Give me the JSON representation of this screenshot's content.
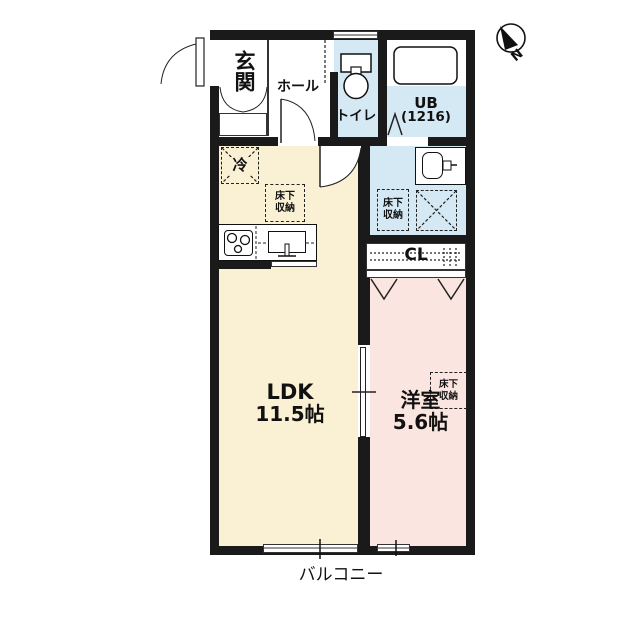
{
  "rooms": {
    "entrance": {
      "label": "玄関"
    },
    "hall": {
      "label": "ホール"
    },
    "toilet": {
      "label": "トイレ"
    },
    "unit_bath": {
      "label": "UB",
      "size": "(1216)"
    },
    "ldk": {
      "label": "LDK",
      "size": "11.5帖"
    },
    "western_room": {
      "label": "洋室",
      "size": "5.6帖"
    },
    "closet": {
      "label": "CL"
    },
    "balcony": {
      "label": "バルコニー"
    }
  },
  "fixtures": {
    "refrigerator": "冷",
    "underfloor_storage": "床下収納",
    "underfloor_storage_line1": "床下",
    "underfloor_storage_line2": "収納"
  },
  "compass": {
    "north": "N"
  },
  "colors": {
    "ldk_floor": "#FAF0D4",
    "western_floor": "#FBE5E0",
    "wet_area_floor": "#D5E9F5",
    "wall": "#1A1A1A"
  }
}
